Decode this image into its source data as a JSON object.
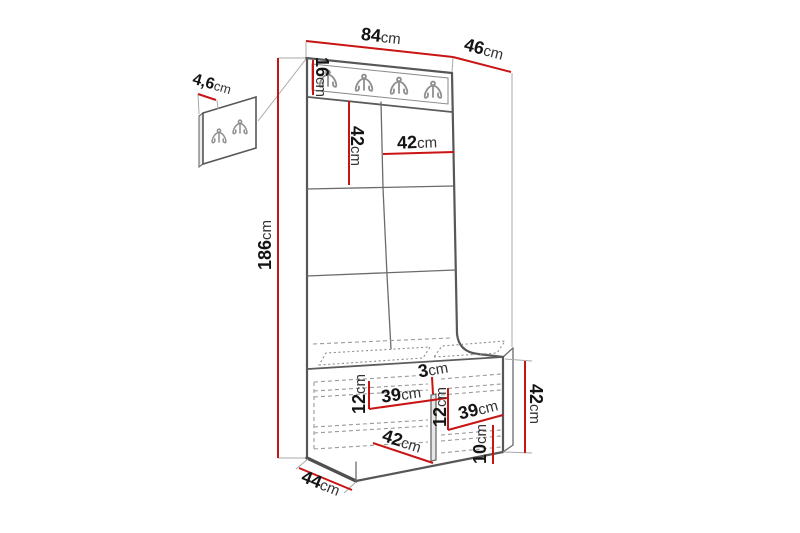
{
  "diagram": {
    "kind": "hallway furniture dimension drawing",
    "unit_suffix": "cm",
    "rail_hook_count": 4,
    "wall_panel_hook_count": 2,
    "accent_color": "#c91414",
    "line_color": "#575757"
  },
  "dims": {
    "width": {
      "v": "84",
      "u": "cm"
    },
    "depth": {
      "v": "46",
      "u": "cm"
    },
    "rail_height": {
      "v": "16",
      "u": "cm"
    },
    "tile_height": {
      "v": "42",
      "u": "cm"
    },
    "tile_width": {
      "v": "42",
      "u": "cm"
    },
    "total_height": {
      "v": "186",
      "u": "cm"
    },
    "panel_thickness": {
      "v": "4,6",
      "u": "cm"
    },
    "divider": {
      "v": "3",
      "u": "cm"
    },
    "shelf_drop_left": {
      "v": "12",
      "u": "cm"
    },
    "shelf_width_left": {
      "v": "39",
      "u": "cm"
    },
    "shelf_drop_mid": {
      "v": "12",
      "u": "cm"
    },
    "shelf_width_right": {
      "v": "39",
      "u": "cm"
    },
    "plinth_height": {
      "v": "10",
      "u": "cm"
    },
    "bench_inner_depth": {
      "v": "42",
      "u": "cm"
    },
    "bench_depth": {
      "v": "44",
      "u": "cm"
    },
    "bench_height": {
      "v": "42",
      "u": "cm"
    }
  }
}
